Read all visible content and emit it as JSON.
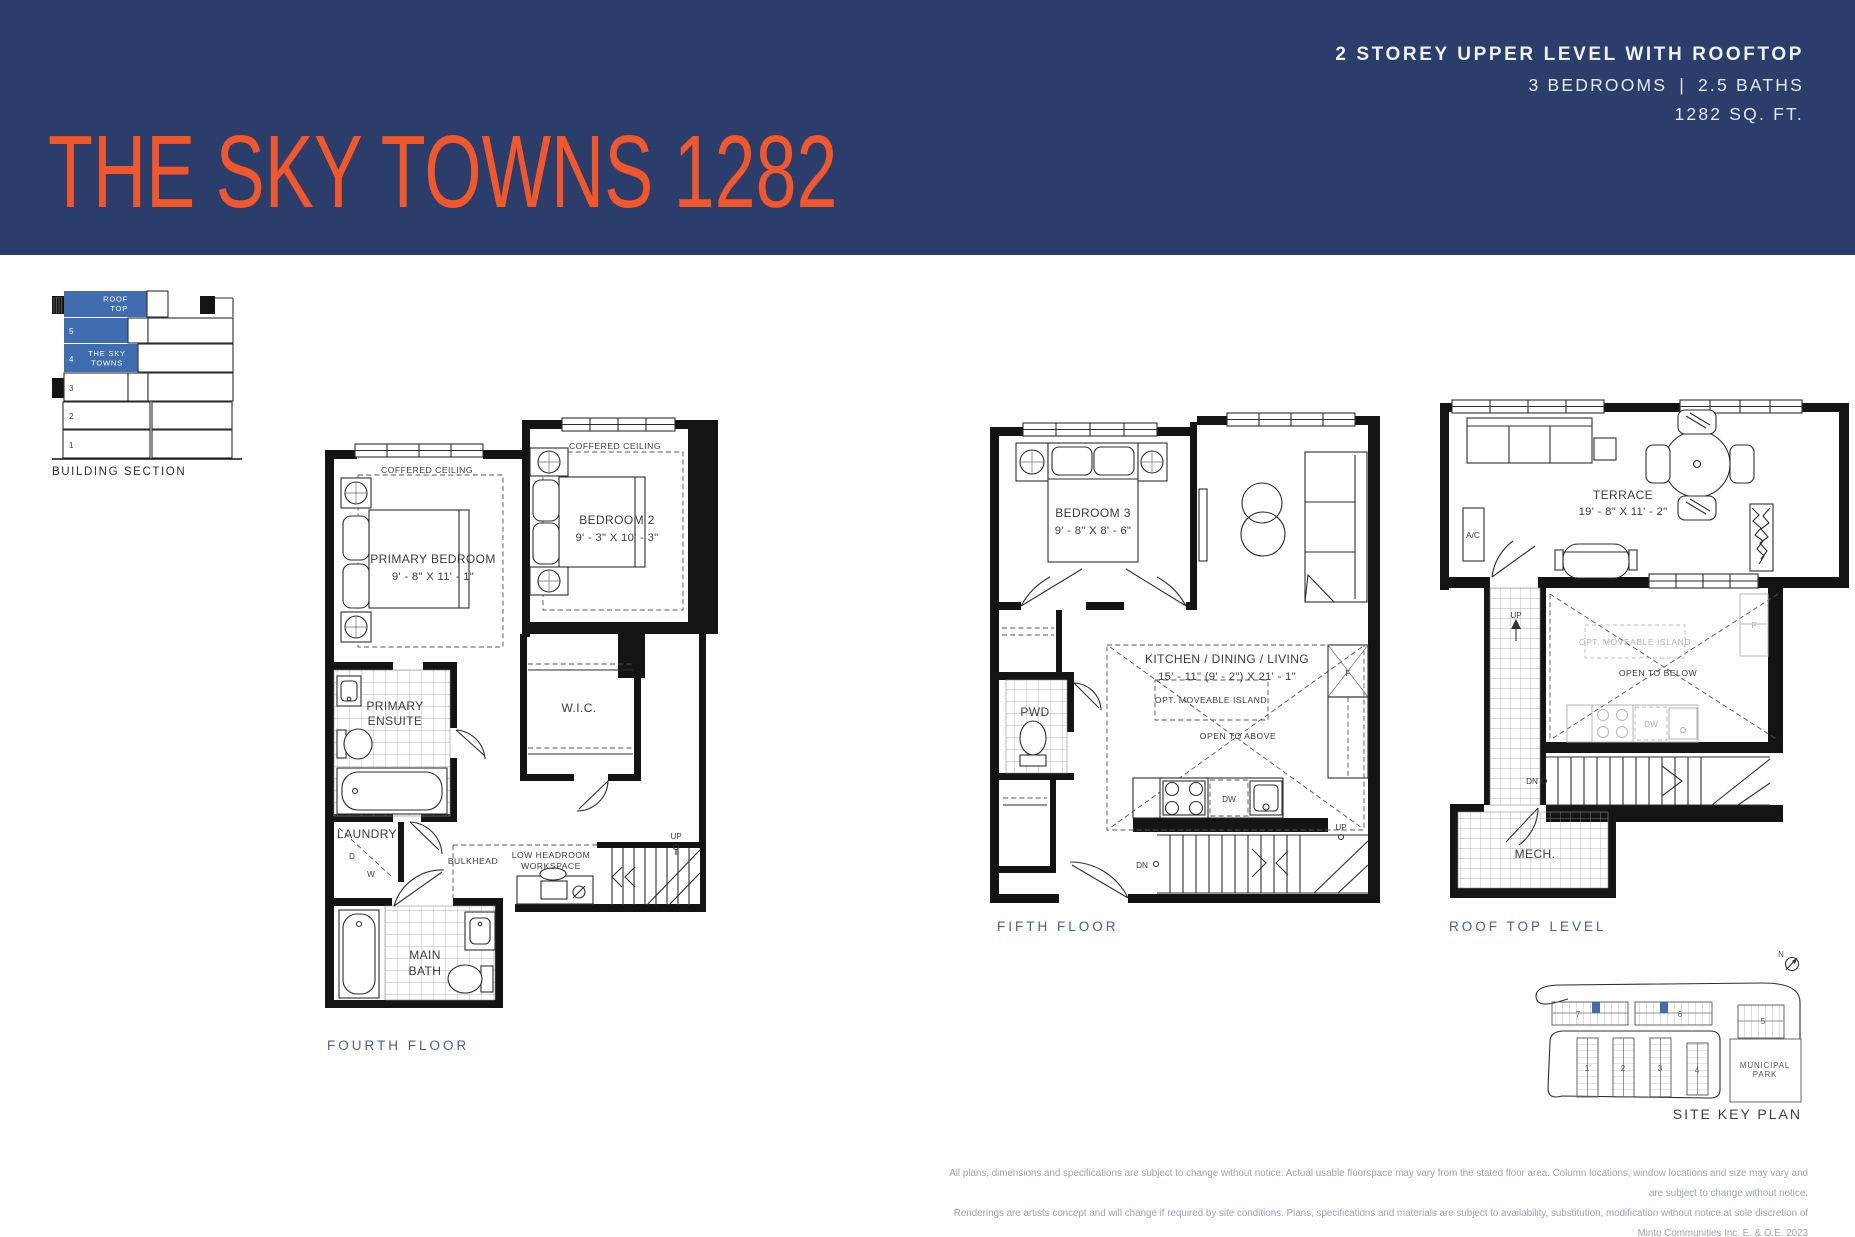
{
  "header": {
    "title": "THE SKY TOWNS 1282",
    "spec_line1": "2 STOREY UPPER LEVEL WITH ROOFTOP",
    "spec_beds": "3 BEDROOMS",
    "spec_sep": "|",
    "spec_baths": "2.5 BATHS",
    "spec_area": "1282 SQ. FT."
  },
  "colors": {
    "navy": "#2b3d6b",
    "orange": "#f1572b",
    "plan_blue": "#3f6db0",
    "caption_blue": "#46619c"
  },
  "building_section": {
    "caption": "BUILDING SECTION",
    "rooftop": [
      "ROOF",
      "TOP"
    ],
    "floor5": "5",
    "floor4_num": "4",
    "floor4_name": [
      "THE SKY",
      "TOWNS"
    ],
    "floor3": "3",
    "floor2": "2",
    "floor1": "1"
  },
  "fourth_floor": {
    "caption": "FOURTH FLOOR",
    "coffered": "COFFERED CEILING",
    "primary_name": "PRIMARY BEDROOM",
    "primary_dims": "9' - 8\" X 11' - 1\"",
    "bed2_name": "BEDROOM 2",
    "bed2_dims": "9' - 3\" X 10' - 3\"",
    "ensuite": [
      "PRIMARY",
      "ENSUITE"
    ],
    "wic": "W.I.C.",
    "laundry": "LAUNDRY",
    "laundry_d": "D",
    "laundry_w": "W",
    "bulkhead": "BULKHEAD",
    "low_headroom": [
      "LOW HEADROOM",
      "WORKSPACE"
    ],
    "main_bath": [
      "MAIN",
      "BATH"
    ],
    "up": "UP"
  },
  "fifth_floor": {
    "caption": "FIFTH FLOOR",
    "bed3_name": "BEDROOM 3",
    "bed3_dims": "9' - 8\" X 8' - 6\"",
    "kdl_name": "KITCHEN / DINING / LIVING",
    "kdl_dims": "15' - 11\" (9' - 2\") X 21' - 1\"",
    "island": "OPT. MOVEABLE ISLAND",
    "open_above": "OPEN TO ABOVE",
    "pwd": "PWD",
    "dw": "DW",
    "fridge": "F",
    "up": "UP",
    "dn": "DN"
  },
  "roof_level": {
    "caption": "ROOF TOP LEVEL",
    "terrace_name": "TERRACE",
    "terrace_dims": "19' - 8\" X 11' - 2\"",
    "ac": "A/C",
    "mech": "MECH.",
    "island_ghost": "OPT. MOVEABLE ISLAND",
    "open_below": "OPEN TO BELOW",
    "dw": "DW",
    "fridge": "F",
    "up": "UP",
    "dn": "DN"
  },
  "site_key": {
    "caption": "SITE KEY PLAN",
    "north": "N",
    "park": [
      "MUNICIPAL",
      "PARK"
    ],
    "b1": "1",
    "b2": "2",
    "b3": "3",
    "b4": "4",
    "b5": "5",
    "b6": "6",
    "b7": "7"
  },
  "disclaimer": {
    "line1": "All plans, dimensions and specifications are subject to change without notice. Actual usable floorspace may vary from the stated floor area. Column locations, window locations and size may vary and are subject to change without notice.",
    "line2": "Renderings are artists concept and will change if required by site conditions. Plans, specifications and materials are subject to availability, substitution, modification without notice at sole discretion of Minto Communities Inc. E. & O.E. 2023"
  }
}
